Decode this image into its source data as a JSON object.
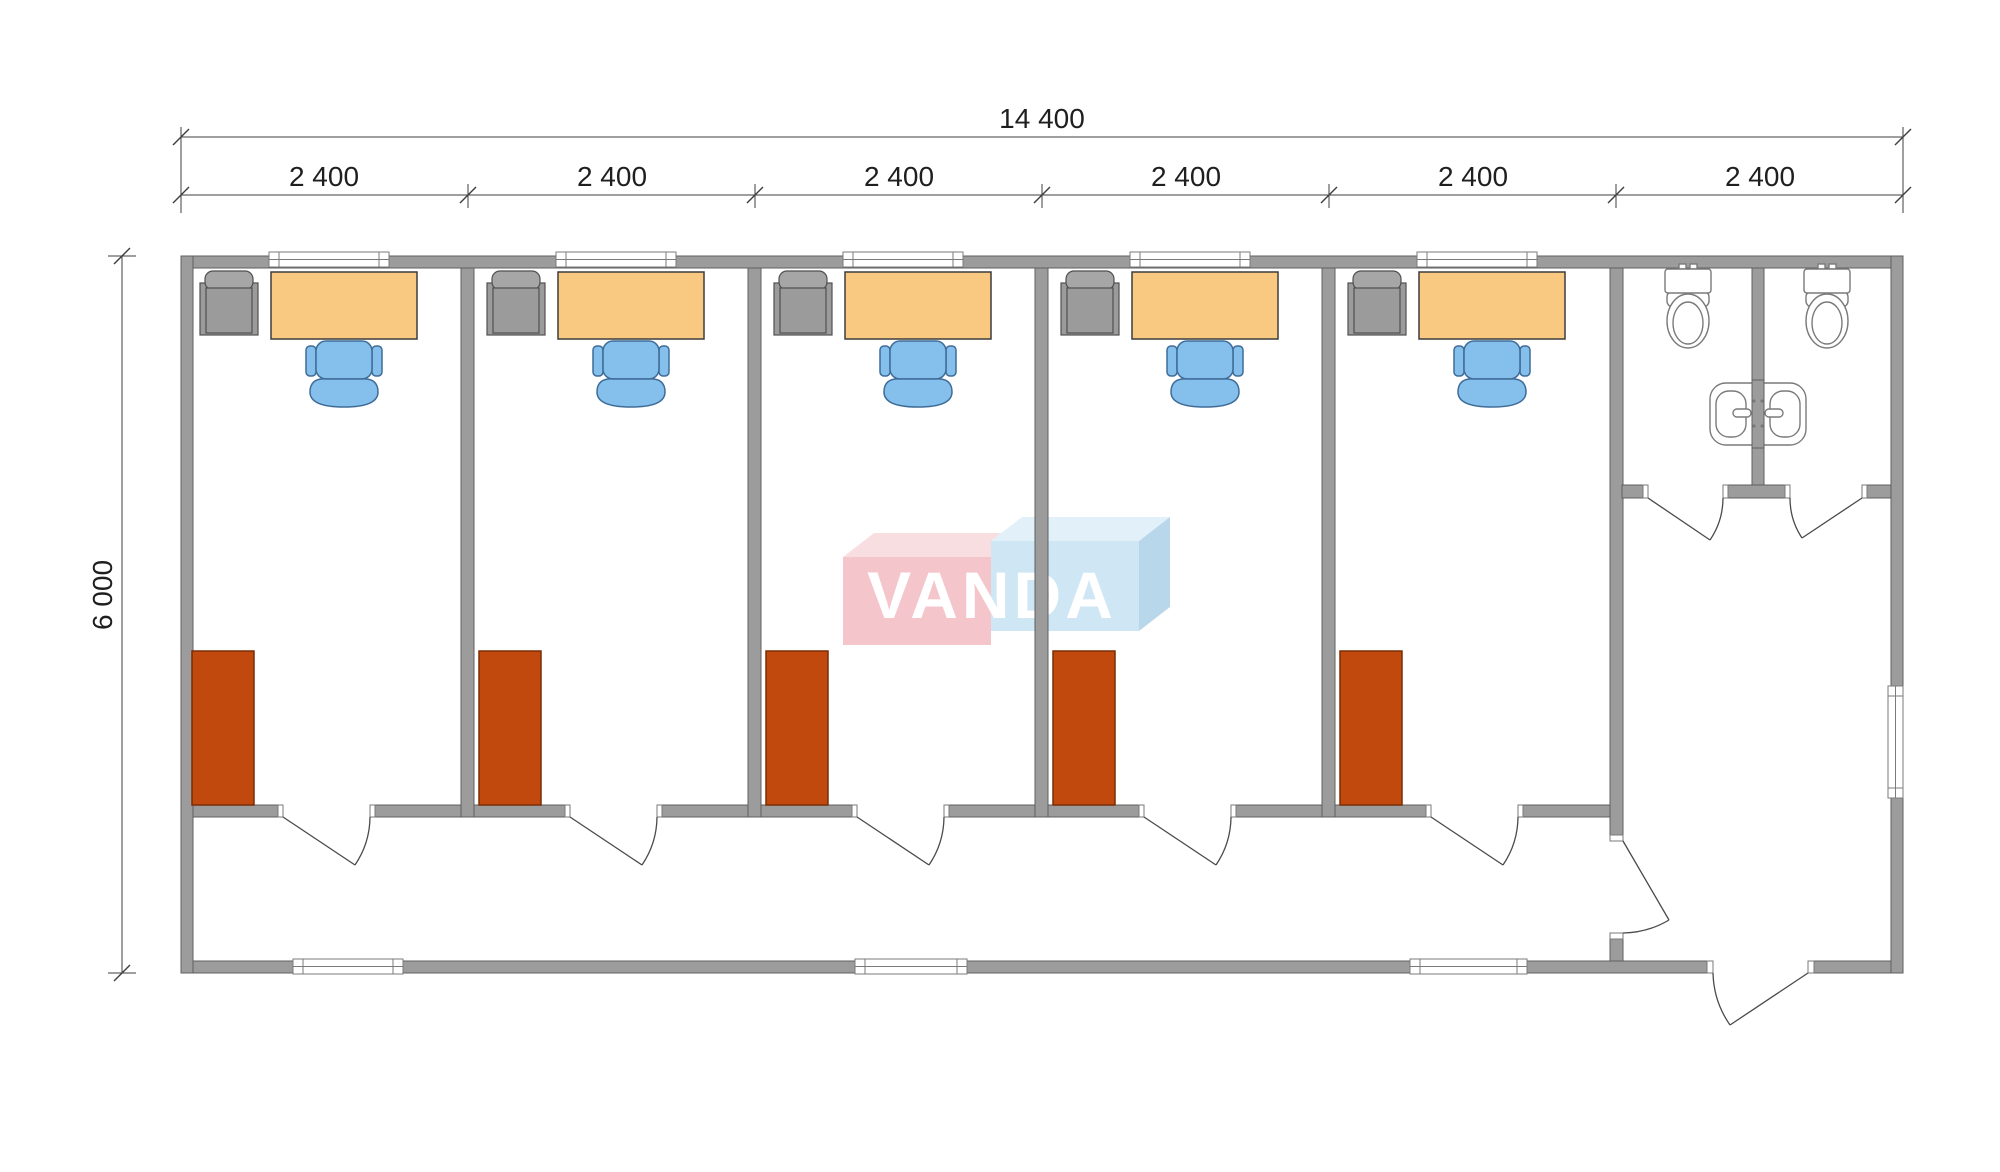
{
  "dimensions": {
    "total_width_label": "14 400",
    "segment_labels": [
      "2 400",
      "2 400",
      "2 400",
      "2 400",
      "2 400",
      "2 400"
    ],
    "height_label": "6 000"
  },
  "logo": {
    "text": "VANDA"
  },
  "plan": {
    "type": "floor-plan",
    "overall_width_mm": 14400,
    "overall_depth_mm": 6000,
    "module_width_mm": 2400,
    "office_rooms": 5,
    "office_furniture_per_room": [
      "cabinet-armchair",
      "desk",
      "office-chair",
      "wardrobe"
    ],
    "sanitary_block": {
      "wc_stalls": 2,
      "toilets": 2,
      "washbasins": 2
    },
    "corridor": true,
    "entrance_vestibule": true,
    "windows": {
      "front_wall": 5,
      "back_wall": 3,
      "side_wall": 1
    },
    "doors": {
      "office_doors": 5,
      "wc_stall_doors": 2,
      "vestibule_door": 1,
      "entrance_door": 1
    }
  },
  "colors": {
    "wall": "#9c9c9c",
    "wall_outline": "#5f5f5f",
    "opening": "#ffffff",
    "cap_outline": "#7a7a7a",
    "window_outline": "#7b7b7b",
    "door_line": "#4a4a4a",
    "desk": "#f9c981",
    "desk_outline": "#3c3c3c",
    "chair": "#85c0ed",
    "chair_outline": "#3f6c97",
    "armchair": "#9b9b9b",
    "armchair_light": "#a6a6a6",
    "armchair_outline": "#4f4f4f",
    "wardrobe": "#c1490e",
    "wardrobe_outline": "#7a2d05",
    "fixture_outline": "#7a7a7a",
    "dim_line": "#3f3f3f",
    "dim_text": "#1f1f1f",
    "logo_pink": "#f4c6cc",
    "logo_pink_top": "#f9dee1",
    "logo_blue": "#cfe6f5",
    "logo_blue_top": "#e2f0fa",
    "logo_blue_side": "#b9d7eb",
    "logo_text": "#ffffff"
  }
}
